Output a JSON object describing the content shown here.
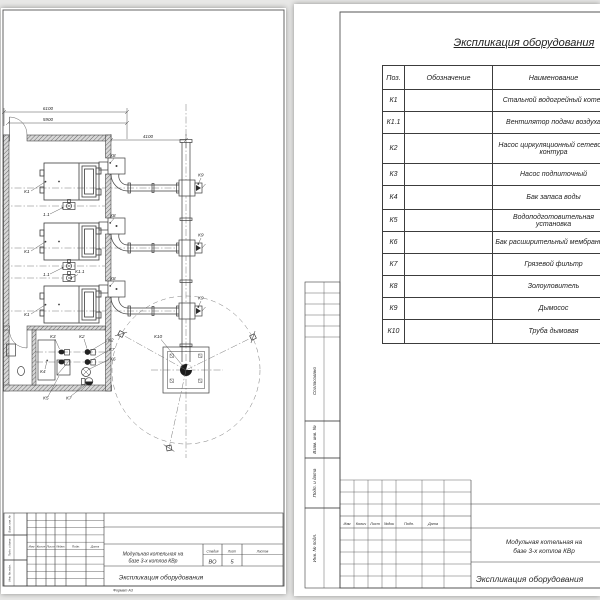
{
  "colors": {
    "page_bg": "#e7e7e6",
    "sheet_bg": "#ffffff",
    "line": "#3c3c3c"
  },
  "stamp_headers": [
    "Изм",
    "Колич",
    "Лист",
    "№док",
    "Подп.",
    "Дата"
  ],
  "left_sheet": {
    "drawing": {
      "dimensions": {
        "overall_width": "6100",
        "inner_width": "5900",
        "flue_run": "4100"
      },
      "labels": {
        "boiler": "К1",
        "boiler_fan": "К1.1",
        "boiler_fan_short": "1.1",
        "ash_collector": "К8",
        "smoke_exhauster": "К9",
        "chimney": "К10",
        "circulation_pump": "К2",
        "feed_pump": "К3",
        "water_tank": "К4",
        "water_treatment": "К5",
        "membrane_tank": "К6",
        "dirt_filter": "К7"
      }
    },
    "stamp": {
      "project_line1": "Модульная котельная на",
      "project_line2": "базе 3-х котлов КВр",
      "document": "Экспликация оборудования",
      "stage_label": "Стадия",
      "stage_value": "ВО",
      "sheet_label": "Лист",
      "sheet_value": "5",
      "sheets_label": "Листов",
      "format_note": "Формат А3"
    },
    "side_labels": [
      "Взам. инв. №",
      "Подп. и дата",
      "Инв. № подл."
    ]
  },
  "right_sheet": {
    "title": "Экспликация оборудования",
    "table": {
      "headers": [
        "Поз.",
        "Обозначение",
        "Наименование"
      ],
      "rows": [
        {
          "pos": "К1",
          "designation": "",
          "name": "Стальной водогрейный котел"
        },
        {
          "pos": "К1.1",
          "designation": "",
          "name": "Вентилятор подачи воздуха"
        },
        {
          "pos": "К2",
          "designation": "",
          "name": "Насос циркуляционный сетевого контура"
        },
        {
          "pos": "К3",
          "designation": "",
          "name": "Насос подпиточный"
        },
        {
          "pos": "К4",
          "designation": "",
          "name": "Бак запаса воды"
        },
        {
          "pos": "К5",
          "designation": "",
          "name": "Водоподготовительная установка"
        },
        {
          "pos": "К6",
          "designation": "",
          "name": "Бак расширительный мембранный"
        },
        {
          "pos": "К7",
          "designation": "",
          "name": "Грязевой фильтр"
        },
        {
          "pos": "К8",
          "designation": "",
          "name": "Золоуловитель"
        },
        {
          "pos": "К9",
          "designation": "",
          "name": "Дымосос"
        },
        {
          "pos": "К10",
          "designation": "",
          "name": "Труба дымовая"
        }
      ]
    },
    "side_labels": [
      "Согласовано",
      "Взам. инв. №",
      "Подп. и дата",
      "Инв. № подл."
    ],
    "stamp": {
      "project_line1": "Модульная котельная на",
      "project_line2": "базе 3-х котлов КВр",
      "document": "Экспликация оборудования"
    }
  }
}
